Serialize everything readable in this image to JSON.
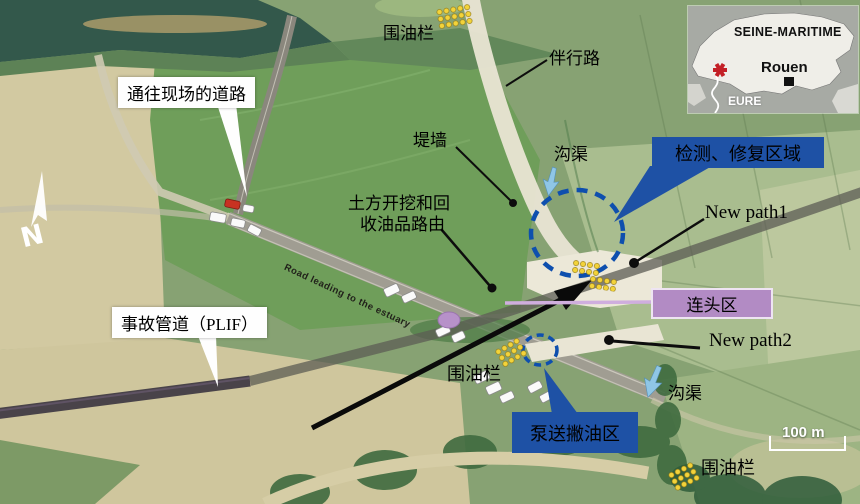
{
  "scene": {
    "road_surface_text": "Road leading to the estuary",
    "compass_label": "N",
    "scale_label": "100 m"
  },
  "callouts": {
    "access_road": "通往现场的道路",
    "incident_pipeline": "事故管道（PLIF）"
  },
  "area_boxes": {
    "inspection_repair": "检测、修复区域",
    "pumping_skimming": "泵送撇油区",
    "tie_in": "连头区"
  },
  "labels": {
    "oil_boom_top": "围油栏",
    "oil_boom_mid": "围油栏",
    "oil_boom_bottom": "围油栏",
    "parallel_road": "伴行路",
    "dike_wall": "堤墙",
    "ditch_top": "沟渠",
    "ditch_bottom": "沟渠",
    "excavation_route_line1": "土方开挖和回",
    "excavation_route_line2": "收油品路由",
    "new_path1": "New path1",
    "new_path2": "New path2"
  },
  "inset_map": {
    "region": "SEINE-MARITIME",
    "city": "Rouen",
    "neighbor_region": "EURE"
  },
  "colors": {
    "area_box_blue": "#1e51a5",
    "tie_in_purple": "#b28bc4",
    "dashed_circle_blue": "#0e4fae",
    "boom_yellow": "#f3d33a",
    "water_teal": "#33584b",
    "incident_star_red": "#c32026"
  }
}
